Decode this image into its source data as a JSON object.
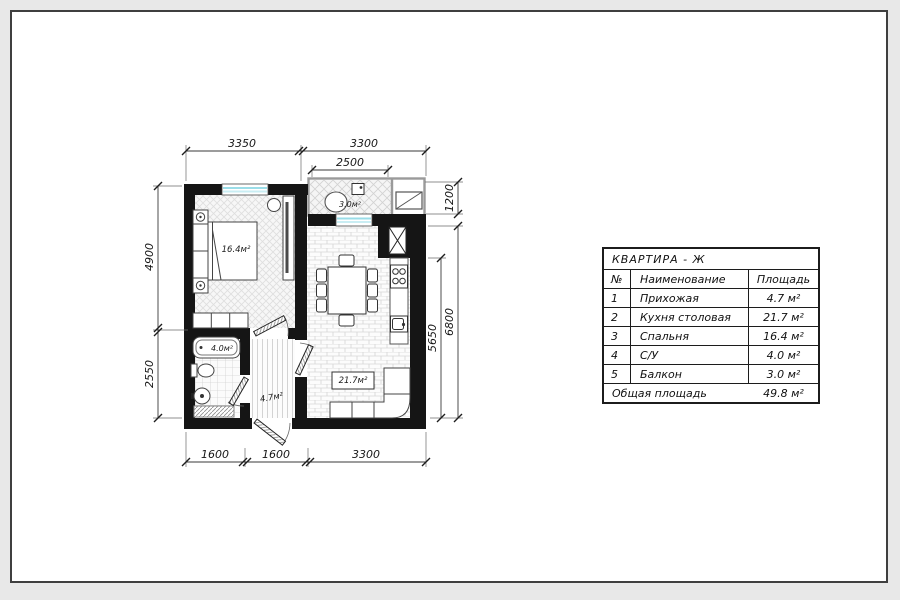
{
  "colors": {
    "background": "#e8e8e8",
    "paper": "#ffffff",
    "frame": "#3f3f3f",
    "wall": "#151515",
    "window_glass": "#9adde8",
    "dimension_line": "#333333"
  },
  "plan": {
    "rooms": {
      "bedroom": {
        "label": "16.4м²"
      },
      "kitchen": {
        "label": "21.7м²"
      },
      "hall": {
        "label": "4.7м²"
      },
      "bath": {
        "label": "4.0м²"
      },
      "balcony": {
        "label": "3.0м²"
      }
    },
    "dimensions": {
      "top_left": "3350",
      "top_right": "3300",
      "top_balcony": "2500",
      "bottom_1": "1600",
      "bottom_2": "1600",
      "bottom_3": "3300",
      "left_upper": "4900",
      "left_lower": "2550",
      "right_inner": "5650",
      "right_outer": "6800",
      "right_balcony": "1200"
    }
  },
  "table": {
    "title": "КВАРТИРА - Ж",
    "columns": [
      "№",
      "Наименование",
      "Площадь"
    ],
    "rows": [
      {
        "num": "1",
        "name": "Прихожая",
        "area": "4.7 м²"
      },
      {
        "num": "2",
        "name": "Кухня столовая",
        "area": "21.7 м²"
      },
      {
        "num": "3",
        "name": "Спальня",
        "area": "16.4 м²"
      },
      {
        "num": "4",
        "name": "С/У",
        "area": "4.0 м²"
      },
      {
        "num": "5",
        "name": "Балкон",
        "area": "3.0 м²"
      }
    ],
    "footer": {
      "name": "Общая площадь",
      "area": "49.8 м²"
    }
  }
}
